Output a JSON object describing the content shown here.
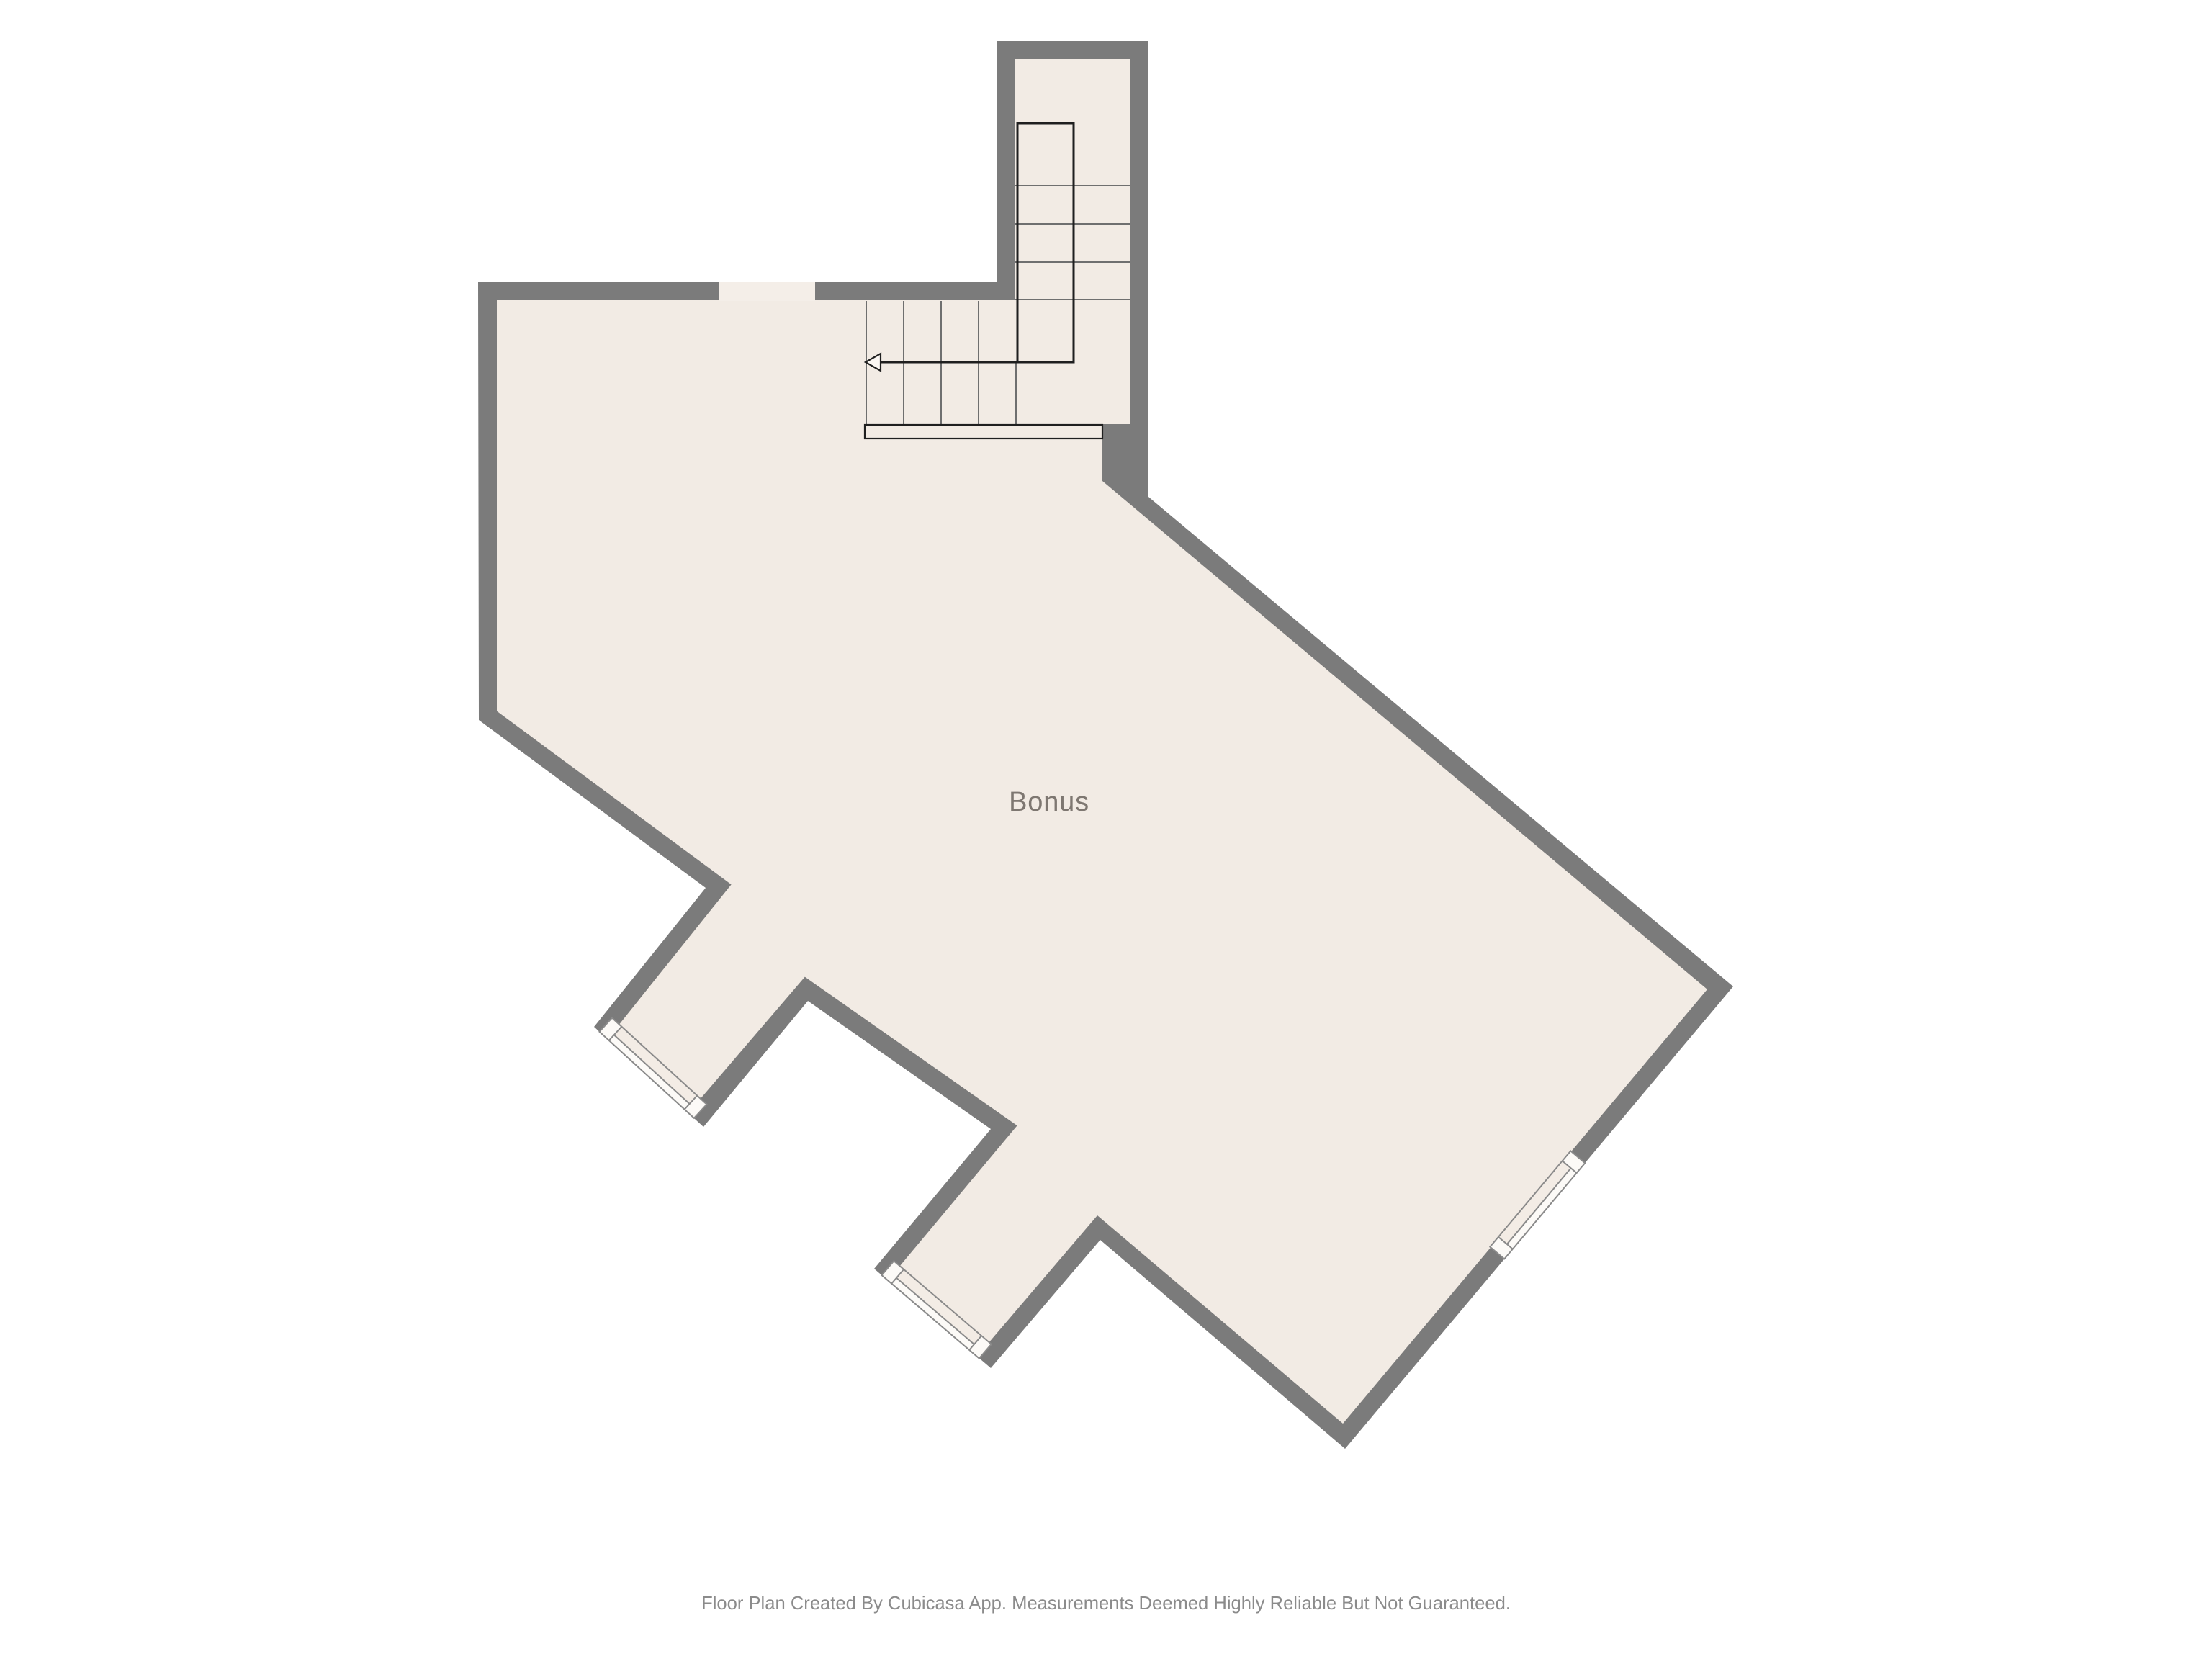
{
  "floor_plan": {
    "app_name": "Cubicasa",
    "room_label": "Bonus",
    "footer": "Floor Plan Created By Cubicasa App. Measurements Deemed Highly Reliable But Not Guaranteed.",
    "colors": {
      "background": "#ffffff",
      "wall": "#7b7b7b",
      "floor": "#f2ebe4",
      "wall_opening": "#f4eee8",
      "window_fill": "#fcfaf7",
      "window_band": "#f3ece5",
      "window_frame": "#8a8a8a",
      "tread_line": "#6f6f6f",
      "stair_outline": "#1f1f1f",
      "arrowhead_fill": "#fbf7f3",
      "landing_fill": "#f2ebe4",
      "label_color": "#7e7771",
      "footer_color": "#8b8b8b"
    },
    "stairs": {
      "type": "L-shaped",
      "upper_flight_treads": 4,
      "lower_run_treads": 4,
      "direction_arrow": "points-left"
    },
    "windows": [
      {
        "id": "window-1",
        "location": "southwest protrusion 1 end wall"
      },
      {
        "id": "window-2",
        "location": "southwest protrusion 2 end wall"
      },
      {
        "id": "window-3",
        "location": "southeast wall"
      }
    ]
  }
}
